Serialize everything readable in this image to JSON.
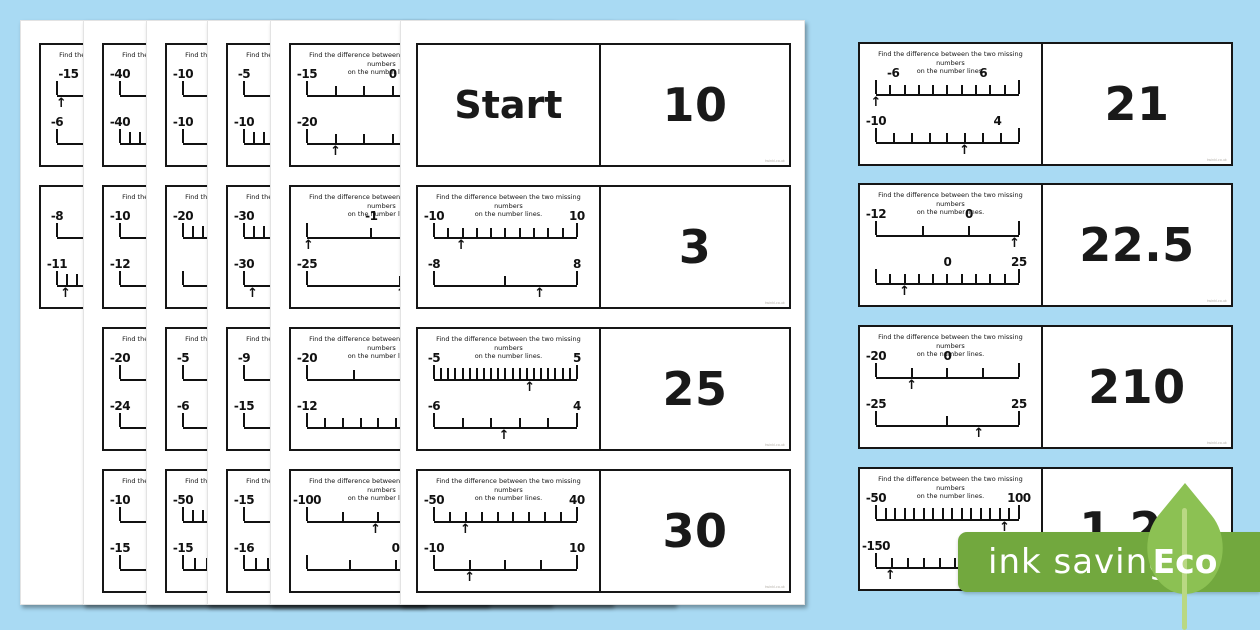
{
  "background_color": "#a9daf3",
  "watermark": "twinkl.co.uk",
  "question": {
    "line1": "Find the difference between the two missing numbers",
    "line2": "on the number lines."
  },
  "badge": {
    "label": "ink saving",
    "eco": "Eco",
    "band_color": "#72a83e",
    "leaf_color": "#8cc153",
    "stem_color": "#b9d883",
    "text_color": "#ffffff"
  },
  "front_page": {
    "cards": [
      {
        "row": 0,
        "start": "Start",
        "answer": "10"
      },
      {
        "row": 1,
        "answer": "3",
        "nl1": {
          "labels": [
            {
              "t": "-10",
              "p": 0
            },
            {
              "t": "10",
              "p": 100
            }
          ],
          "segs": 10,
          "arrow": 19
        },
        "nl2": {
          "labels": [
            {
              "t": "-8",
              "p": 0
            },
            {
              "t": "8",
              "p": 100
            }
          ],
          "ticks": [
            0,
            50,
            100
          ],
          "arrow": 74
        }
      },
      {
        "row": 2,
        "answer": "25",
        "nl1": {
          "labels": [
            {
              "t": "-5",
              "p": 0
            },
            {
              "t": "5",
              "p": 100
            }
          ],
          "segs": 20,
          "arrow": 67
        },
        "nl2": {
          "labels": [
            {
              "t": "-6",
              "p": 0
            },
            {
              "t": "4",
              "p": 100
            }
          ],
          "segs": 5,
          "arrow": 49
        }
      },
      {
        "row": 3,
        "answer": "30",
        "nl1": {
          "labels": [
            {
              "t": "-50",
              "p": 0
            },
            {
              "t": "40",
              "p": 100
            }
          ],
          "segs": 9,
          "arrow": 22
        },
        "nl2": {
          "labels": [
            {
              "t": "-10",
              "p": 0
            },
            {
              "t": "10",
              "p": 100
            }
          ],
          "ticks": [
            0,
            25,
            50,
            75,
            100
          ],
          "arrow": 25
        }
      }
    ]
  },
  "right_cards": [
    {
      "answer": "21",
      "nl1": {
        "labels": [
          {
            "t": "-6",
            "p": 12
          },
          {
            "t": "6",
            "p": 75
          }
        ],
        "segs": 10,
        "arrow": 0
      },
      "nl2": {
        "labels": [
          {
            "t": "-10",
            "p": 0
          },
          {
            "t": "4",
            "p": 85
          }
        ],
        "segs": 8,
        "arrow": 62
      }
    },
    {
      "answer": "22.5",
      "nl1": {
        "labels": [
          {
            "t": "-12",
            "p": 0
          },
          {
            "t": "0",
            "p": 65
          }
        ],
        "ticks": [
          0,
          33,
          65,
          100
        ],
        "arrow": 97
      },
      "nl2": {
        "labels": [
          {
            "t": "0",
            "p": 50
          },
          {
            "t": "25",
            "p": 100
          }
        ],
        "segs": 10,
        "arrow": 20
      }
    },
    {
      "answer": "210",
      "nl1": {
        "labels": [
          {
            "t": "-20",
            "p": 0
          },
          {
            "t": "0",
            "p": 50
          }
        ],
        "ticks": [
          0,
          25,
          50,
          75,
          100
        ],
        "arrow": 25
      },
      "nl2": {
        "labels": [
          {
            "t": "-25",
            "p": 0
          },
          {
            "t": "25",
            "p": 100
          }
        ],
        "ticks": [
          0,
          50,
          100
        ],
        "arrow": 72
      }
    },
    {
      "answer": "1.25",
      "nl1": {
        "labels": [
          {
            "t": "-50",
            "p": 0
          },
          {
            "t": "100",
            "p": 100
          }
        ],
        "segs": 15,
        "arrow": 90
      },
      "nl2": {
        "labels": [
          {
            "t": "-150",
            "p": 0
          }
        ],
        "segs": 9,
        "arrow": 10
      }
    }
  ],
  "stack_pages": [
    {
      "left": 20,
      "cards": [
        {
          "row": 0,
          "nl1": {
            "labels": [
              {
                "t": "-15",
                "p": 8
              }
            ],
            "segs": 4,
            "arrow": 3
          },
          "nl2": {
            "labels": [
              {
                "t": "-6",
                "p": 0
              }
            ],
            "segs": 2
          }
        },
        {
          "row": 1,
          "q": false,
          "nl1": {
            "labels": [
              {
                "t": "-8",
                "p": 0
              }
            ],
            "segs": 4
          },
          "nl2": {
            "labels": [
              {
                "t": "-11",
                "p": 0
              }
            ],
            "segs": 14,
            "arrow": 6
          }
        }
      ]
    },
    {
      "left": 83,
      "cards": [
        {
          "row": 0,
          "nl1": {
            "labels": [
              {
                "t": "-40",
                "p": 0
              }
            ],
            "segs": 4
          },
          "nl2": {
            "labels": [
              {
                "t": "-40",
                "p": 0
              }
            ],
            "segs": 14
          }
        },
        {
          "row": 1,
          "nl1": {
            "labels": [
              {
                "t": "-10",
                "p": 0
              }
            ],
            "segs": 4
          },
          "nl2": {
            "labels": [
              {
                "t": "-12",
                "p": 0
              }
            ],
            "segs": 4
          }
        },
        {
          "row": 2,
          "nl1": {
            "labels": [
              {
                "t": "-20",
                "p": 0
              }
            ],
            "segs": 2
          },
          "nl2": {
            "labels": [
              {
                "t": "-24",
                "p": 0
              }
            ],
            "segs": 4
          }
        },
        {
          "row": 3,
          "nl1": {
            "labels": [
              {
                "t": "-10",
                "p": 0
              }
            ],
            "segs": 2
          },
          "nl2": {
            "labels": [
              {
                "t": "-15",
                "p": 0
              }
            ],
            "segs": 2
          }
        }
      ]
    },
    {
      "left": 146,
      "cards": [
        {
          "row": 0,
          "nl1": {
            "labels": [
              {
                "t": "-10",
                "p": 0
              }
            ],
            "segs": 4
          },
          "nl2": {
            "labels": [
              {
                "t": "-10",
                "p": 0
              }
            ],
            "segs": 2
          }
        },
        {
          "row": 1,
          "nl1": {
            "labels": [
              {
                "t": "-20",
                "p": 0
              }
            ],
            "segs": 14
          },
          "nl2": {
            "labels": [],
            "segs": 2
          }
        },
        {
          "row": 2,
          "nl1": {
            "labels": [
              {
                "t": "-5",
                "p": 0
              }
            ],
            "segs": 4
          },
          "nl2": {
            "labels": [
              {
                "t": "-6",
                "p": 0
              }
            ],
            "segs": 2
          }
        },
        {
          "row": 3,
          "nl1": {
            "labels": [
              {
                "t": "-50",
                "p": 0
              }
            ],
            "segs": 14
          },
          "nl2": {
            "labels": [
              {
                "t": "-15",
                "p": 0
              }
            ],
            "segs": 12
          }
        }
      ]
    },
    {
      "left": 207,
      "cards": [
        {
          "row": 0,
          "nl1": {
            "labels": [
              {
                "t": "-5",
                "p": 0
              }
            ],
            "segs": 4
          },
          "nl2": {
            "labels": [
              {
                "t": "-10",
                "p": 0
              }
            ],
            "segs": 14
          }
        },
        {
          "row": 1,
          "nl1": {
            "labels": [
              {
                "t": "-30",
                "p": 0
              }
            ],
            "segs": 14
          },
          "nl2": {
            "labels": [
              {
                "t": "-30",
                "p": 0
              }
            ],
            "segs": 4,
            "arrow": 6
          }
        },
        {
          "row": 2,
          "nl1": {
            "labels": [
              {
                "t": "-9",
                "p": 0
              }
            ],
            "segs": 2
          },
          "nl2": {
            "labels": [
              {
                "t": "-15",
                "p": 0
              }
            ],
            "segs": 2
          }
        },
        {
          "row": 3,
          "nl1": {
            "labels": [
              {
                "t": "-15",
                "p": 0
              }
            ],
            "segs": 2
          },
          "nl2": {
            "labels": [
              {
                "t": "-16",
                "p": 0
              }
            ],
            "segs": 12
          }
        }
      ]
    },
    {
      "left": 270,
      "cards": [
        {
          "row": 0,
          "nl1": {
            "labels": [
              {
                "t": "-15",
                "p": 0
              },
              {
                "t": "0",
                "p": 60
              }
            ],
            "segs": 5
          },
          "nl2": {
            "labels": [
              {
                "t": "-20",
                "p": 0
              }
            ],
            "segs": 5,
            "arrow": 20
          }
        },
        {
          "row": 1,
          "nl1": {
            "labels": [
              {
                "t": "-1",
                "p": 45
              }
            ],
            "ticks": [
              0,
              45,
              100
            ],
            "arrow": 1
          },
          "nl2": {
            "labels": [
              {
                "t": "-25",
                "p": 0
              }
            ],
            "ticks": [
              0,
              65,
              100
            ],
            "arrow": 66
          }
        },
        {
          "row": 2,
          "nl1": {
            "labels": [
              {
                "t": "-20",
                "p": 0
              }
            ],
            "ticks": [
              0,
              33,
              66,
              100
            ]
          },
          "nl2": {
            "labels": [
              {
                "t": "-12",
                "p": 0
              }
            ],
            "segs": 8
          }
        },
        {
          "row": 3,
          "nl1": {
            "labels": [
              {
                "t": "-100",
                "p": 0
              }
            ],
            "ticks": [
              0,
              25,
              50,
              75,
              100
            ],
            "arrow": 48
          },
          "nl2": {
            "labels": [
              {
                "t": "0",
                "p": 62
              }
            ],
            "ticks": [
              0,
              30,
              62,
              100
            ]
          }
        }
      ]
    }
  ]
}
